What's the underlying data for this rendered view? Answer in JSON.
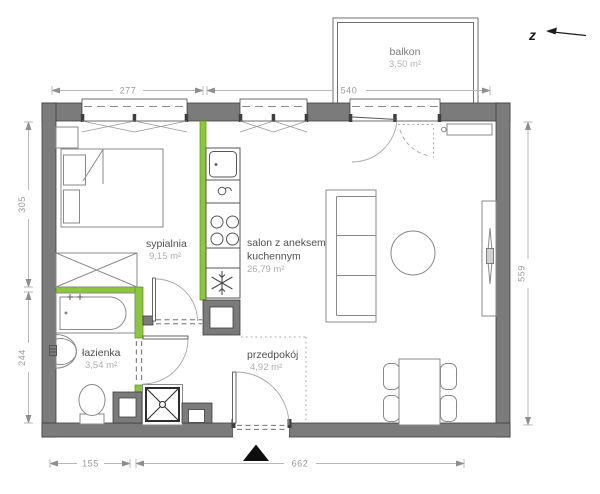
{
  "plan": {
    "title": "apartment-floor-plan",
    "north_label": "z",
    "rooms": {
      "bedroom": {
        "name": "sypialnia",
        "area": "9,15 m²"
      },
      "living": {
        "name_line1": "salon z aneksem",
        "name_line2": "kuchennym",
        "area": "26,79 m²"
      },
      "bathroom": {
        "name": "łazienka",
        "area": "3,54 m²"
      },
      "hallway": {
        "name": "przedpokój",
        "area": "4,92 m²"
      },
      "balcony": {
        "name": "balkon",
        "area": "3,50 m²"
      }
    },
    "dimensions": {
      "top_window": "277",
      "top_balcony": "540",
      "left_upper": "305",
      "left_lower": "244",
      "right_side": "559",
      "bottom_left": "155",
      "bottom_right": "662"
    },
    "colors": {
      "wall": "#7b7b7b",
      "accent": "#8cc63e"
    }
  }
}
